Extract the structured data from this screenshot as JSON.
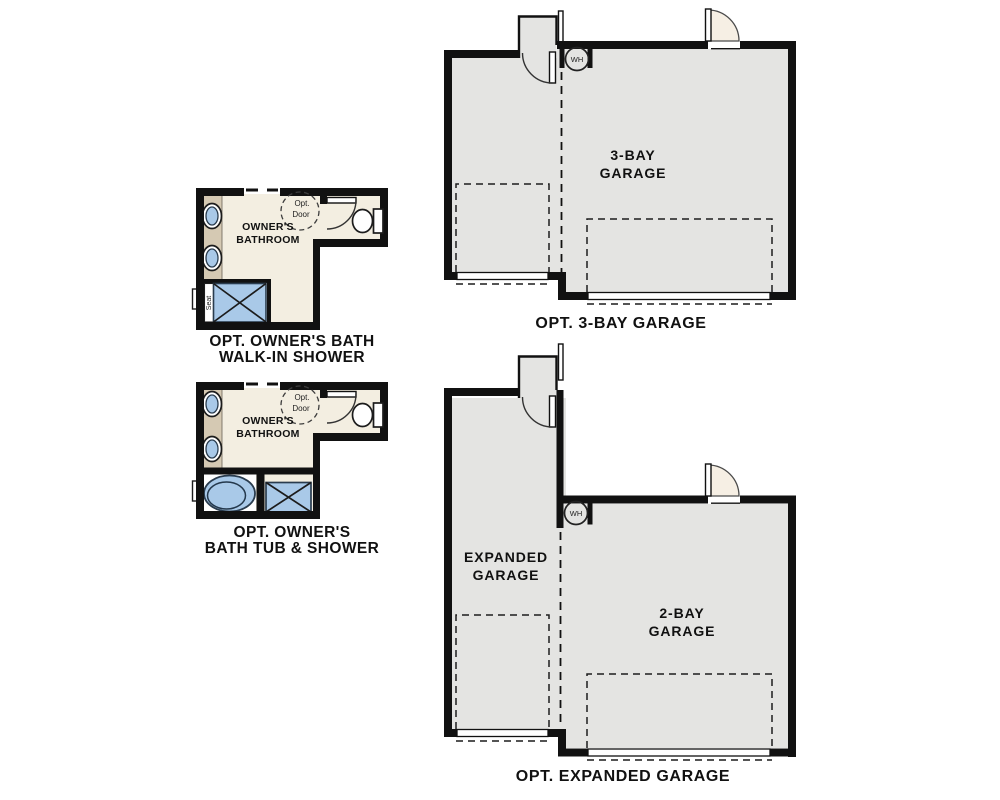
{
  "colors": {
    "wall": "#111111",
    "garage_fill": "#e4e4e2",
    "floor": "#f3eee1",
    "vanity": "#d5c9b3",
    "fixture_blue": "#a9c9e8",
    "door_swing": "#f6efe4",
    "text": "#111111"
  },
  "plans": {
    "bath_walkin": {
      "room_line1": "OWNER'S",
      "room_line2": "BATHROOM",
      "opt_door_line1": "Opt.",
      "opt_door_line2": "Door",
      "seat_label": "Seat",
      "caption_line1": "OPT. OWNER'S BATH",
      "caption_line2": "WALK-IN SHOWER"
    },
    "bath_tub": {
      "room_line1": "OWNER'S",
      "room_line2": "BATHROOM",
      "opt_door_line1": "Opt.",
      "opt_door_line2": "Door",
      "caption_line1": "OPT. OWNER'S",
      "caption_line2": "BATH TUB & SHOWER"
    },
    "garage_3bay": {
      "label_line1": "3-BAY",
      "label_line2": "GARAGE",
      "wh_label": "WH",
      "caption": "OPT. 3-BAY GARAGE"
    },
    "garage_expanded": {
      "left_label_line1": "EXPANDED",
      "left_label_line2": "GARAGE",
      "right_label_line1": "2-BAY",
      "right_label_line2": "GARAGE",
      "wh_label": "WH",
      "caption": "OPT. EXPANDED GARAGE"
    }
  }
}
